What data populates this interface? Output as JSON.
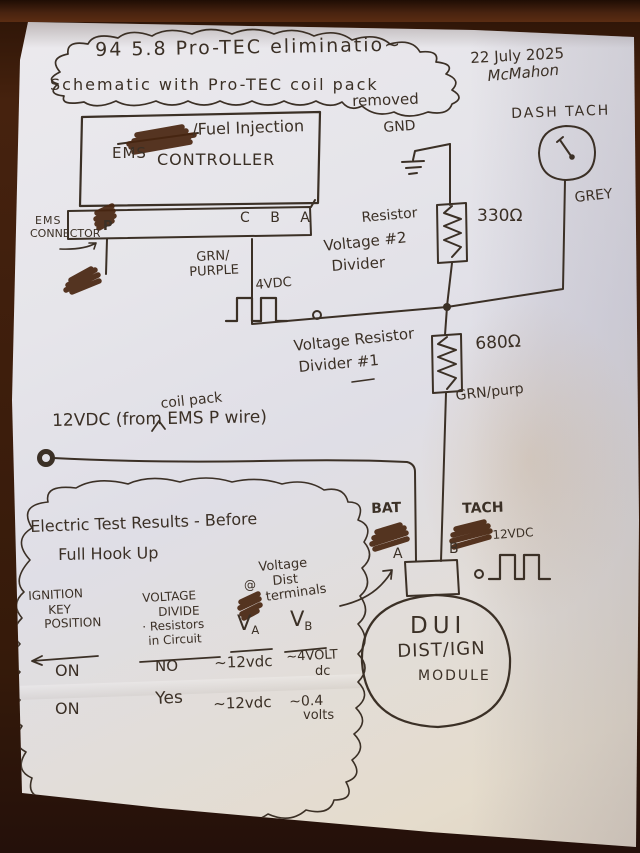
{
  "title_cloud": {
    "line1": "94  5.8  Pro-TEC eliminatio~",
    "line2": "Schematic  with  Pro-TEC  coil pack",
    "line3": "removed"
  },
  "header": {
    "date": "22 July 2025",
    "signature": "McMahon"
  },
  "ems_controller": {
    "strikethrough_note": "/Fuel Injection",
    "name1": "EMS",
    "name2": "CONTROLLER",
    "connector_caption1": "EMS",
    "connector_caption2": "CONNECTOR",
    "pin_p": "P",
    "pins_right": "C  B  A"
  },
  "labels": {
    "gnd": "GND",
    "grn1": "GRN/",
    "grn2": "PURPLE",
    "grn_purp": "GRN/purp",
    "grey": "GREY"
  },
  "signals": {
    "tach_out": "4VDC",
    "dist_tach": "12VDC"
  },
  "dash_tach": {
    "caption": "DASH  TACH"
  },
  "divider2": {
    "caption1": "Voltage #2",
    "caption2": "Divider",
    "resistor_word": "Resistor",
    "value": "330Ω"
  },
  "divider1": {
    "caption1": "Voltage Resistor",
    "caption2": "Divider #1",
    "value": "680Ω"
  },
  "supply": {
    "caption": "12VDC (from  EMS P wire)",
    "insert_above": "coil pack"
  },
  "dui_module": {
    "bat": "BAT",
    "pin_a": "A",
    "tach": "TACH",
    "pin_b": "B",
    "name1": "DUI",
    "name2": "DIST/IGN",
    "name3": "MODULE"
  },
  "results": {
    "title1": "Electric Test Results - Before",
    "title2": "Full Hook Up",
    "note1": "Voltage",
    "note_at": "@",
    "note2": "Dist",
    "note3": "terminals",
    "col_key": [
      "IGNITION",
      "KEY",
      "POSITION"
    ],
    "col_divide": [
      "VOLTAGE",
      "DIVIDE",
      "· Resistors",
      "in Circuit"
    ],
    "col_va": {
      "v": "V",
      "sub": "A"
    },
    "col_vb": {
      "v": "V",
      "sub": "B"
    },
    "rows": [
      {
        "key": "ON",
        "divide": "NO",
        "va": "~12vdc",
        "vb1": "~4VOLT",
        "vb2": "dc"
      },
      {
        "key": "ON",
        "divide": "Yes",
        "va": "~12vdc",
        "vb1": "~0.4",
        "vb2": "volts"
      }
    ]
  }
}
